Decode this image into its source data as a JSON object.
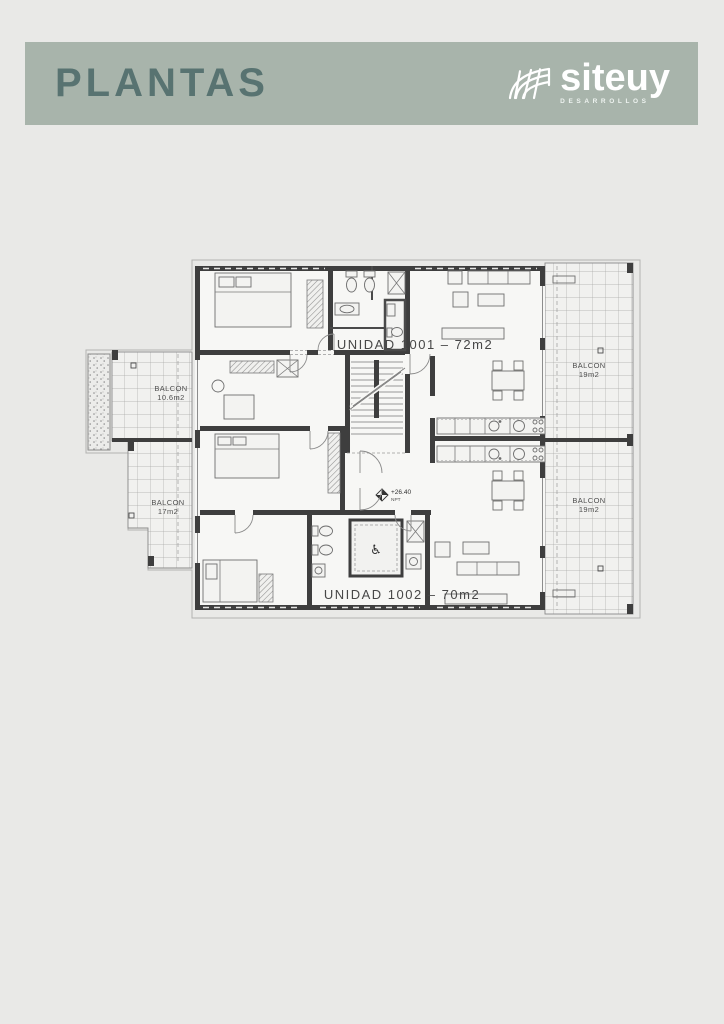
{
  "page": {
    "background": "#e9e9e7"
  },
  "header": {
    "title": "PLANTAS",
    "bg_color": "#a8b4ab",
    "title_color": "#587371",
    "logo": {
      "text": "siteuy",
      "tagline": "DESARROLLOS",
      "color": "#ffffff",
      "icon": "dome-grid-icon"
    }
  },
  "plan": {
    "unit_1001_label": "UNIDAD 1001 – 72m2",
    "unit_1002_label": "UNIDAD 1002 – 70m2",
    "balconies": [
      {
        "name": "BALCON",
        "area": "10.6m2"
      },
      {
        "name": "BALCON",
        "area": "17m2"
      },
      {
        "name": "BALCON",
        "area": "19m2"
      },
      {
        "name": "BALCON",
        "area": "19m2"
      }
    ],
    "elevation_marker": {
      "value": "+26.40",
      "label": "NPT"
    },
    "accessible_icon": "♿",
    "colors": {
      "wall": "#3e3e3e",
      "furniture_line": "#6e6e6e",
      "floor": "#f7f7f5",
      "balcony_floor": "#f1f1ef",
      "property_line": "#b2b2b0"
    }
  }
}
